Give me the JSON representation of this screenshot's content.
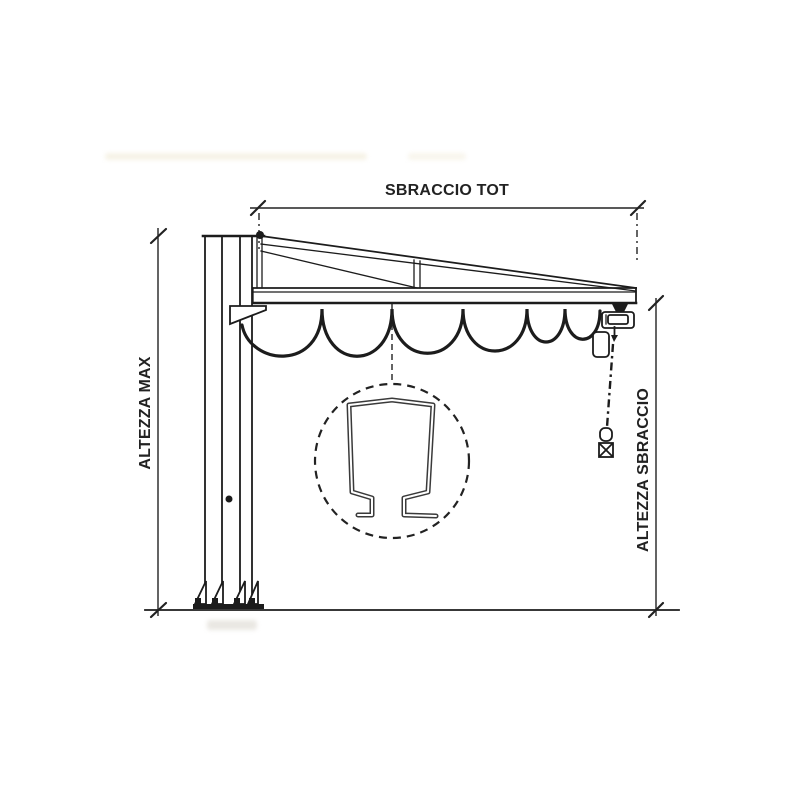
{
  "diagram": {
    "labels": {
      "top_dimension": "SBRACCIO TOT",
      "left_dimension": "ALTEZZA MAX",
      "right_dimension": "ALTEZZA SBRACCIO"
    },
    "colors": {
      "line": "#1c1c1c",
      "dimension_line": "#222222",
      "background": "#ffffff",
      "profile_outline": "#3a3a3a",
      "smudge": "#f3eede"
    },
    "components": [
      "support-column",
      "base-plate-with-gussets-and-anchor-bolts",
      "pivot-pin",
      "jib-truss-arm",
      "runway-beam",
      "festoon-cable",
      "chain-hoist-trolley",
      "chain-bag",
      "load-chain",
      "hook-block",
      "beam-profile-detail-callout",
      "ground-line"
    ]
  }
}
